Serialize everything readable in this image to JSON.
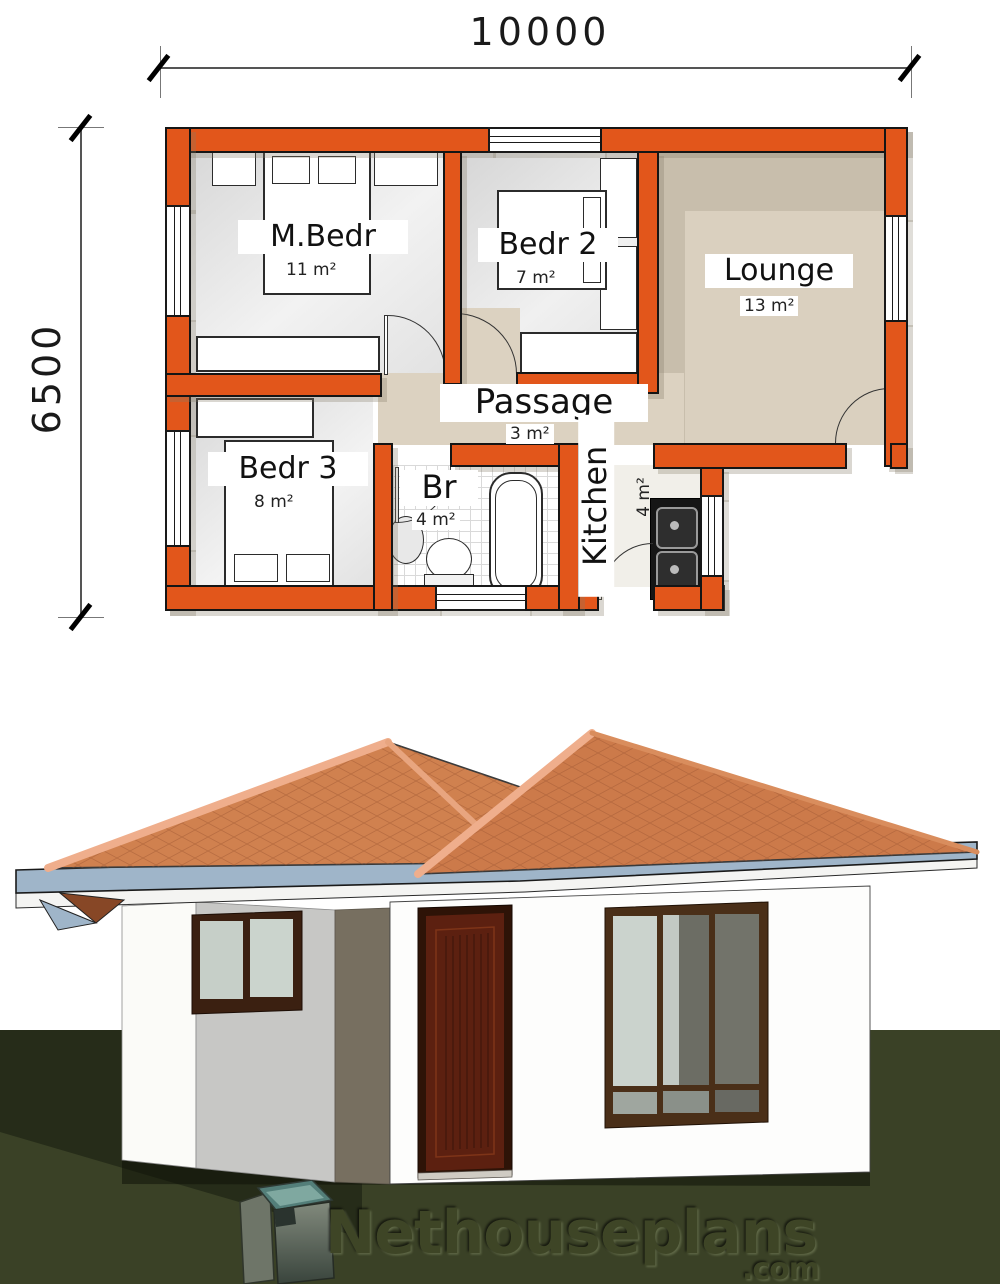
{
  "plan": {
    "width_dim": "10000",
    "height_dim": "6500",
    "rooms": [
      {
        "name": "M.Bedr",
        "area": "11 m²"
      },
      {
        "name": "Bedr 2",
        "area": "7 m²"
      },
      {
        "name": "Lounge",
        "area": "13 m²"
      },
      {
        "name": "Passage",
        "area": "3 m²"
      },
      {
        "name": "Bedr 3",
        "area": "8 m²"
      },
      {
        "name": "Br",
        "area": "4 m²"
      },
      {
        "name": "Kitchen",
        "area": "4 m²"
      }
    ]
  },
  "watermark": {
    "brand": "Nethouseplans",
    "tld": ".com"
  },
  "palette": {
    "wall_orange": "#E2561B",
    "floor_tan": "#DCD2C1",
    "floor_gray": "#DFDFDF",
    "roof_tile": "#CE7C4D",
    "fascia_blue": "#9FB5C9",
    "grass_green": "#3A4126",
    "door_brown": "#5C2010",
    "logo_teal": "#537E79"
  }
}
